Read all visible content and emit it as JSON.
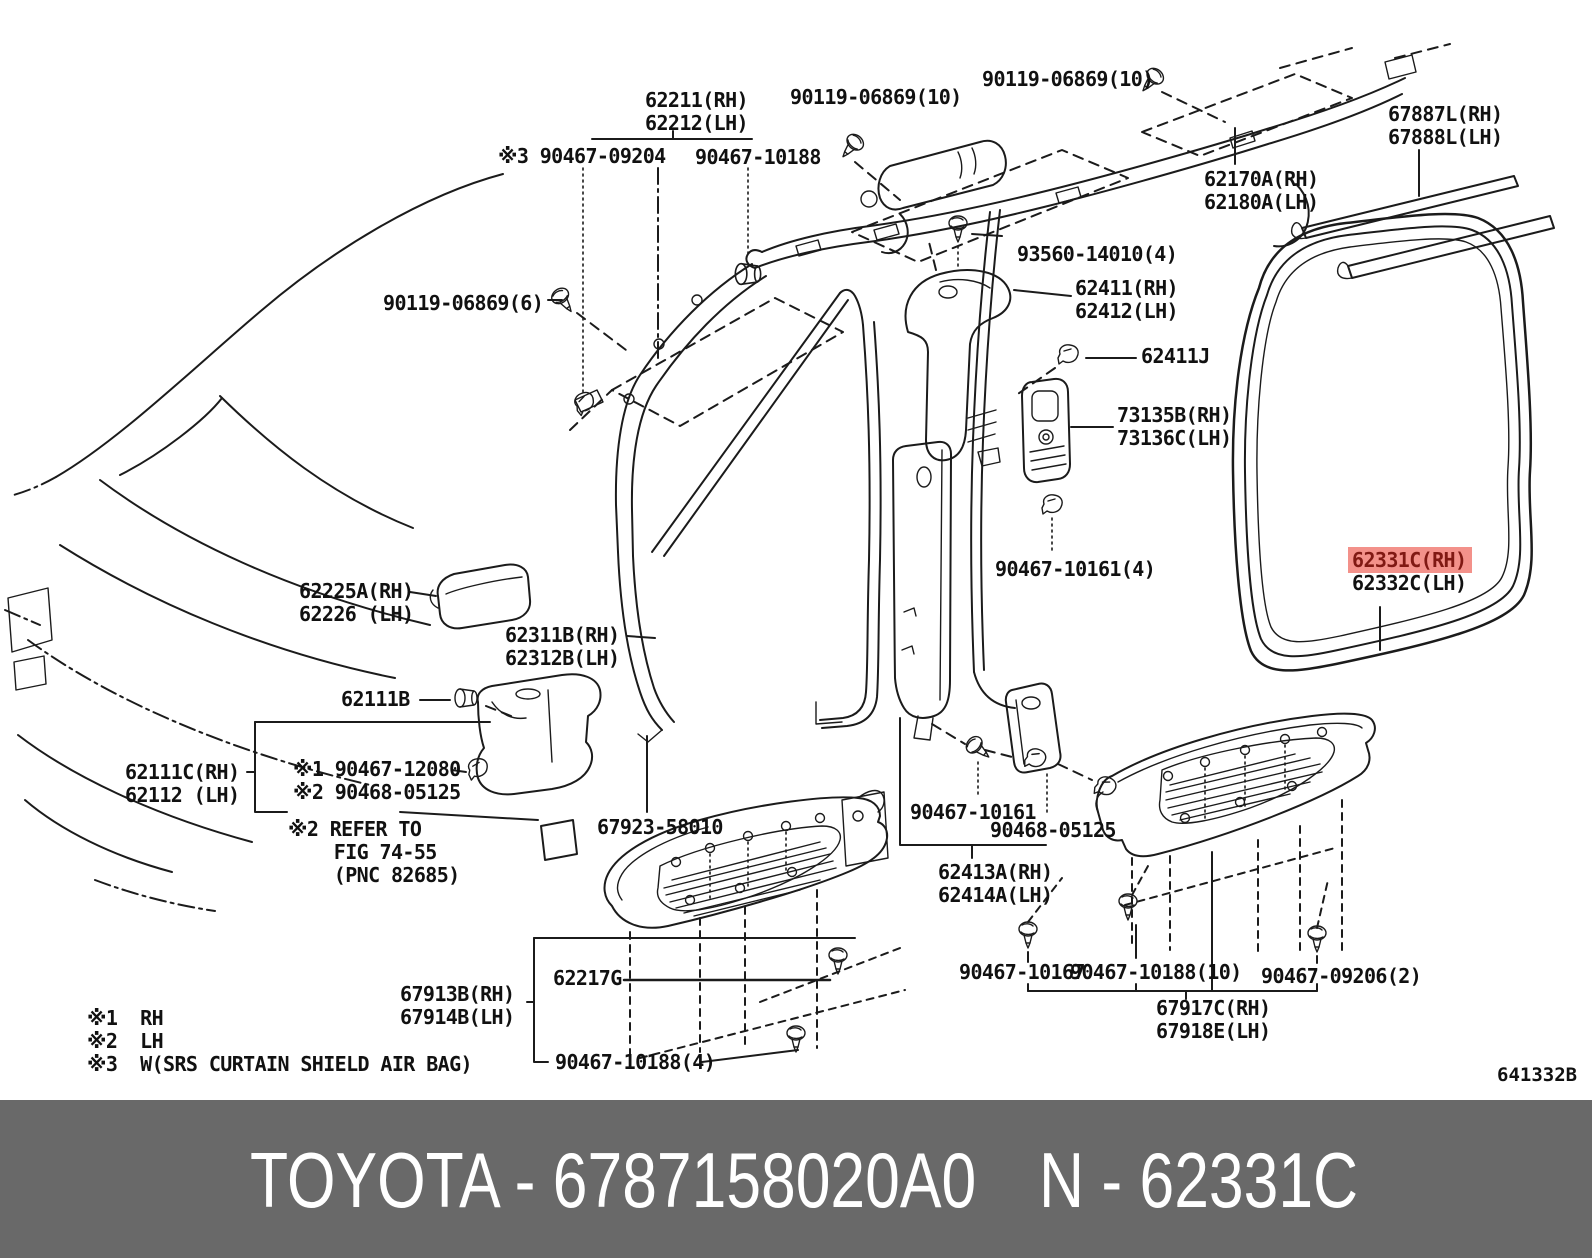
{
  "banner": {
    "left": "TOYOTA - 6787158020A0",
    "right": "N - 62331C",
    "bg": "#696969",
    "fg": "#ffffff"
  },
  "diagram_code": "641332B",
  "highlight": {
    "color": "#f3918a",
    "text_color": "#801913",
    "part": "62331C(RH)"
  },
  "legend": [
    {
      "marker": "※1",
      "text": "RH",
      "x": 87,
      "y": 1006
    },
    {
      "marker": "※2",
      "text": "LH",
      "x": 87,
      "y": 1029
    },
    {
      "marker": "※3",
      "text": "W(SRS CURTAIN SHIELD AIR BAG)",
      "x": 87,
      "y": 1052
    }
  ],
  "labels": [
    {
      "id": "62211-62212",
      "x": 645,
      "y": 89,
      "lines": [
        "62211(RH)",
        "62212(LH)"
      ]
    },
    {
      "id": "90119-06869-10-a",
      "x": 790,
      "y": 86,
      "lines": [
        "90119-06869(10)"
      ]
    },
    {
      "id": "90119-06869-10-b",
      "x": 982,
      "y": 68,
      "lines": [
        "90119-06869(10)"
      ]
    },
    {
      "id": "90467-09204",
      "x": 498,
      "y": 145,
      "lines": [
        "※3 90467-09204"
      ]
    },
    {
      "id": "90467-10188-top",
      "x": 695,
      "y": 146,
      "lines": [
        "90467-10188"
      ]
    },
    {
      "id": "67887-67888",
      "x": 1388,
      "y": 103,
      "lines": [
        "67887L(RH)",
        "67888L(LH)"
      ]
    },
    {
      "id": "62170-62180",
      "x": 1204,
      "y": 168,
      "lines": [
        "62170A(RH)",
        "62180A(LH)"
      ]
    },
    {
      "id": "93560-14010",
      "x": 1017,
      "y": 243,
      "lines": [
        "93560-14010(4)"
      ]
    },
    {
      "id": "90119-06869-6",
      "x": 383,
      "y": 292,
      "lines": [
        "90119-06869(6)"
      ]
    },
    {
      "id": "62411-62412",
      "x": 1075,
      "y": 277,
      "lines": [
        "62411(RH)",
        "62412(LH)"
      ]
    },
    {
      "id": "62411J",
      "x": 1141,
      "y": 345,
      "lines": [
        "62411J"
      ]
    },
    {
      "id": "73135-73136",
      "x": 1117,
      "y": 404,
      "lines": [
        "73135B(RH)",
        "73136C(LH)"
      ]
    },
    {
      "id": "90467-10161-4",
      "x": 995,
      "y": 558,
      "lines": [
        "90467-10161(4)"
      ]
    },
    {
      "id": "62331-62332",
      "x": 1352,
      "y": 549,
      "lines": [
        "62331C(RH)",
        "62332C(LH)"
      ],
      "highlight_line": 0
    },
    {
      "id": "62225-62226",
      "x": 299,
      "y": 580,
      "lines": [
        "62225A(RH)",
        "62226 (LH)"
      ]
    },
    {
      "id": "62311-62312",
      "x": 505,
      "y": 624,
      "lines": [
        "62311B(RH)",
        "62312B(LH)"
      ]
    },
    {
      "id": "62111B",
      "x": 341,
      "y": 688,
      "lines": [
        "62111B"
      ]
    },
    {
      "id": "62111C-62112",
      "x": 125,
      "y": 761,
      "lines": [
        "62111C(RH)",
        "62112 (LH)"
      ]
    },
    {
      "id": "90467-12080-90468-05125",
      "x": 293,
      "y": 758,
      "lines": [
        "※1 90467-12080",
        "※2 90468-05125"
      ]
    },
    {
      "id": "refer-fig",
      "x": 288,
      "y": 818,
      "lines": [
        "※2 REFER TO",
        "    FIG 74-55",
        "    (PNC 82685)"
      ]
    },
    {
      "id": "67923-58010",
      "x": 597,
      "y": 816,
      "lines": [
        "67923-58010"
      ]
    },
    {
      "id": "90467-10161",
      "x": 910,
      "y": 801,
      "lines": [
        "90467-10161"
      ]
    },
    {
      "id": "90468-05125",
      "x": 990,
      "y": 819,
      "lines": [
        "90468-05125"
      ]
    },
    {
      "id": "62413-62414",
      "x": 938,
      "y": 861,
      "lines": [
        "62413A(RH)",
        "62414A(LH)"
      ]
    },
    {
      "id": "62217G",
      "x": 553,
      "y": 967,
      "lines": [
        "62217G"
      ]
    },
    {
      "id": "67913-67914",
      "x": 400,
      "y": 983,
      "lines": [
        "67913B(RH)",
        "67914B(LH)"
      ]
    },
    {
      "id": "90467-10188-4",
      "x": 555,
      "y": 1051,
      "lines": [
        "90467-10188(4)"
      ]
    },
    {
      "id": "90467-10167",
      "x": 959,
      "y": 961,
      "lines": [
        "90467-10167"
      ]
    },
    {
      "id": "90467-10188-10",
      "x": 1070,
      "y": 961,
      "lines": [
        "90467-10188(10)"
      ]
    },
    {
      "id": "90467-09206-2",
      "x": 1261,
      "y": 965,
      "lines": [
        "90467-09206(2)"
      ]
    },
    {
      "id": "67917-67918",
      "x": 1156,
      "y": 997,
      "lines": [
        "67917C(RH)",
        "67918E(LH)"
      ]
    }
  ]
}
